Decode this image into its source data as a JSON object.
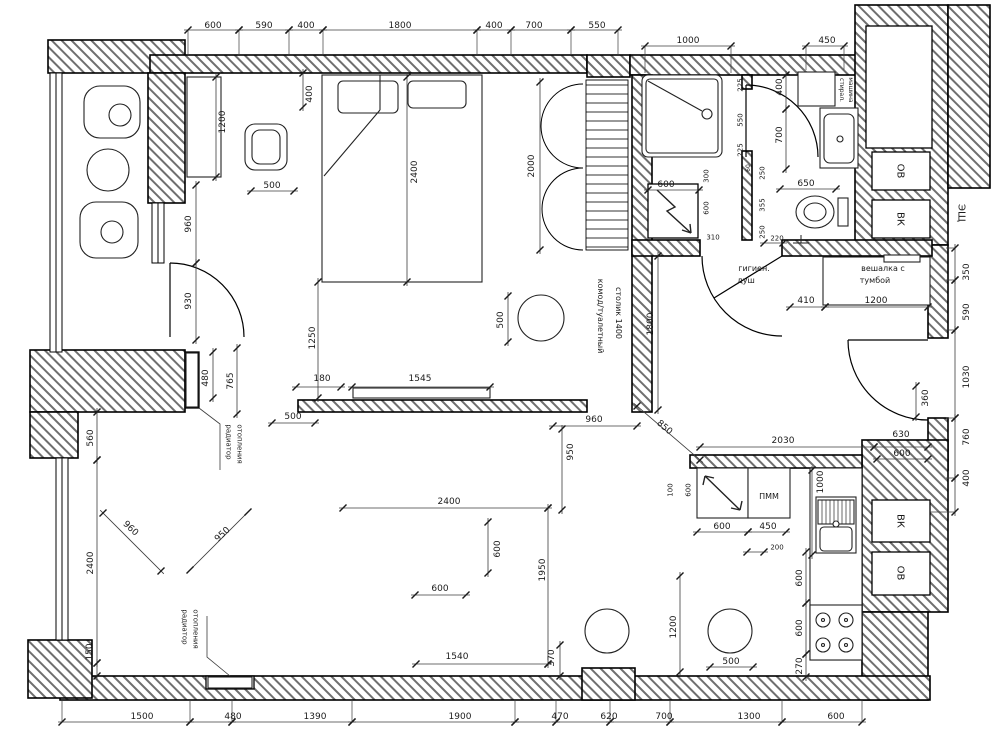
{
  "drawing": {
    "kind": "apartment floor plan",
    "palette": {
      "background": "#ffffff",
      "wall_line": "#000000",
      "hatch": "#6f6f6f",
      "dim_line": "#3c3c3c",
      "text": "#1b1b1b"
    }
  },
  "labels": [
    {
      "t": "600",
      "x": 213,
      "y": 25,
      "l": [
        188,
        30,
        239,
        30
      ]
    },
    {
      "t": "590",
      "x": 264,
      "y": 25,
      "l": [
        239,
        30,
        289,
        30
      ]
    },
    {
      "t": "400",
      "x": 306,
      "y": 25,
      "l": [
        289,
        30,
        323,
        30
      ]
    },
    {
      "t": "1800",
      "x": 400,
      "y": 25,
      "l": [
        323,
        30,
        477,
        30
      ]
    },
    {
      "t": "400",
      "x": 494,
      "y": 25,
      "l": [
        477,
        30,
        511,
        30
      ]
    },
    {
      "t": "700",
      "x": 534,
      "y": 25,
      "l": [
        511,
        30,
        571,
        30
      ]
    },
    {
      "t": "550",
      "x": 597,
      "y": 25,
      "l": [
        571,
        30,
        618,
        30
      ]
    },
    {
      "t": "1000",
      "x": 688,
      "y": 40,
      "l": [
        645,
        46,
        731,
        46
      ]
    },
    {
      "t": "450",
      "x": 827,
      "y": 40,
      "l": [
        806,
        46,
        844,
        46
      ]
    },
    {
      "t": "1500",
      "x": 142,
      "y": 716,
      "l": [
        62,
        722,
        190,
        722
      ]
    },
    {
      "t": "480",
      "x": 233,
      "y": 716,
      "l": [
        190,
        722,
        232,
        722
      ]
    },
    {
      "t": "1390",
      "x": 315,
      "y": 716,
      "l": [
        232,
        722,
        352,
        722
      ]
    },
    {
      "t": "1900",
      "x": 460,
      "y": 716,
      "l": [
        352,
        722,
        515,
        722
      ]
    },
    {
      "t": "470",
      "x": 560,
      "y": 716,
      "l": [
        515,
        722,
        556,
        722
      ]
    },
    {
      "t": "620",
      "x": 609,
      "y": 716,
      "l": [
        556,
        722,
        610,
        722
      ]
    },
    {
      "t": "700",
      "x": 664,
      "y": 716,
      "l": [
        610,
        722,
        670,
        722
      ]
    },
    {
      "t": "1300",
      "x": 749,
      "y": 716,
      "l": [
        670,
        722,
        782,
        722
      ]
    },
    {
      "t": "600",
      "x": 836,
      "y": 716,
      "l": [
        782,
        722,
        862,
        722
      ]
    },
    {
      "t": "350",
      "x": 966,
      "y": 272,
      "r": -90,
      "l": [
        955,
        248,
        955,
        280
      ]
    },
    {
      "t": "590",
      "x": 966,
      "y": 312,
      "r": -90,
      "l": [
        955,
        280,
        955,
        330
      ]
    },
    {
      "t": "1030",
      "x": 966,
      "y": 377,
      "r": -90,
      "l": [
        955,
        330,
        955,
        418
      ]
    },
    {
      "t": "760",
      "x": 966,
      "y": 437,
      "r": -90,
      "l": [
        955,
        418,
        955,
        478
      ]
    },
    {
      "t": "400",
      "x": 966,
      "y": 478,
      "r": -90,
      "l": [
        955,
        478,
        955,
        512
      ]
    },
    {
      "t": "1200",
      "x": 222,
      "y": 122,
      "r": -90,
      "l": [
        216,
        77,
        216,
        177
      ]
    },
    {
      "t": "400",
      "x": 309,
      "y": 94,
      "r": -90,
      "l": [
        303,
        73,
        303,
        107
      ]
    },
    {
      "t": "500",
      "x": 272,
      "y": 185,
      "l": [
        251,
        191,
        294,
        191
      ]
    },
    {
      "t": "2400",
      "x": 414,
      "y": 172,
      "r": -90,
      "l": [
        407,
        77,
        407,
        282
      ]
    },
    {
      "t": "1250",
      "x": 312,
      "y": 338,
      "r": -90,
      "l": [
        318,
        282,
        318,
        398
      ]
    },
    {
      "t": "2000",
      "x": 531,
      "y": 166,
      "r": -90,
      "l": [
        540,
        82,
        540,
        250
      ]
    },
    {
      "t": "500",
      "x": 500,
      "y": 320,
      "r": -90,
      "l": [
        508,
        296,
        508,
        342
      ]
    },
    {
      "t": "960",
      "x": 188,
      "y": 224,
      "r": -90,
      "l": [
        196,
        185,
        196,
        263
      ]
    },
    {
      "t": "930",
      "x": 188,
      "y": 301,
      "r": -90,
      "l": [
        196,
        263,
        196,
        340
      ]
    },
    {
      "t": "480",
      "x": 205,
      "y": 378,
      "r": -90,
      "l": [
        213,
        352,
        213,
        398
      ]
    },
    {
      "t": "765",
      "x": 230,
      "y": 381,
      "r": -90,
      "l": [
        237,
        348,
        237,
        414
      ]
    },
    {
      "t": "560",
      "x": 90,
      "y": 438,
      "r": -90,
      "l": [
        97,
        412,
        97,
        460
      ]
    },
    {
      "t": "2400",
      "x": 90,
      "y": 563,
      "r": -90,
      "l": [
        97,
        460,
        97,
        663
      ]
    },
    {
      "t": "150",
      "x": 89,
      "y": 652,
      "r": -90,
      "l": [
        97,
        663,
        97,
        676
      ]
    },
    {
      "t": "960",
      "x": 131,
      "y": 528,
      "r": 43,
      "l": [
        103,
        513,
        161,
        571
      ]
    },
    {
      "t": "950",
      "x": 222,
      "y": 534,
      "r": -43,
      "l": [
        190,
        570,
        248,
        512
      ]
    },
    {
      "t": "850",
      "x": 665,
      "y": 427,
      "r": 40,
      "l": [
        637,
        406,
        700,
        460
      ]
    },
    {
      "t": "2400",
      "x": 449,
      "y": 501,
      "l": [
        343,
        508,
        548,
        508
      ]
    },
    {
      "t": "600",
      "x": 497,
      "y": 549,
      "r": -90,
      "l": [
        488,
        522,
        488,
        573
      ]
    },
    {
      "t": "600",
      "x": 440,
      "y": 588,
      "l": [
        415,
        595,
        466,
        595
      ]
    },
    {
      "t": "1950",
      "x": 542,
      "y": 570,
      "r": -90,
      "l": [
        548,
        508,
        548,
        664
      ]
    },
    {
      "t": "1540",
      "x": 457,
      "y": 656,
      "l": [
        416,
        664,
        548,
        664
      ]
    },
    {
      "t": "370",
      "x": 551,
      "y": 658,
      "r": -90,
      "l": [
        560,
        645,
        560,
        676
      ]
    },
    {
      "t": "180",
      "x": 322,
      "y": 378,
      "l": [
        296,
        387,
        341,
        387
      ]
    },
    {
      "t": "1545",
      "x": 420,
      "y": 378,
      "l": [
        352,
        387,
        490,
        387
      ]
    },
    {
      "t": "500",
      "x": 293,
      "y": 416,
      "l": [
        272,
        423,
        315,
        423
      ]
    },
    {
      "t": "960",
      "x": 594,
      "y": 419,
      "l": [
        553,
        426,
        637,
        426
      ]
    },
    {
      "t": "950",
      "x": 570,
      "y": 452,
      "r": -90,
      "l": [
        562,
        429,
        562,
        510
      ]
    },
    {
      "t": "1800",
      "x": 650,
      "y": 324,
      "r": -90,
      "l": [
        658,
        256,
        658,
        410
      ]
    },
    {
      "t": "410",
      "x": 806,
      "y": 300,
      "l": [
        790,
        307,
        825,
        307
      ]
    },
    {
      "t": "1200",
      "x": 876,
      "y": 300,
      "l": [
        825,
        307,
        928,
        307
      ]
    },
    {
      "t": "360",
      "x": 925,
      "y": 398,
      "r": -90,
      "l": [
        916,
        386,
        916,
        417
      ]
    },
    {
      "t": "600",
      "x": 666,
      "y": 184,
      "l": [
        648,
        190,
        699,
        190
      ]
    },
    {
      "t": "300",
      "x": 706,
      "y": 176,
      "r": -90,
      "fs": 7
    },
    {
      "t": "600",
      "x": 706,
      "y": 208,
      "r": -90,
      "fs": 7
    },
    {
      "t": "310",
      "x": 713,
      "y": 237,
      "fs": 7
    },
    {
      "t": "225",
      "x": 740,
      "y": 85,
      "r": -90,
      "fs": 7
    },
    {
      "t": "550",
      "x": 740,
      "y": 120,
      "r": -90,
      "fs": 7
    },
    {
      "t": "225",
      "x": 740,
      "y": 150,
      "r": -90,
      "fs": 7
    },
    {
      "t": "60",
      "x": 748,
      "y": 168,
      "r": -90,
      "fs": 6
    },
    {
      "t": "400",
      "x": 779,
      "y": 87,
      "r": -90,
      "l": [
        786,
        75,
        786,
        109
      ]
    },
    {
      "t": "700",
      "x": 779,
      "y": 135,
      "r": -90,
      "l": [
        786,
        109,
        786,
        169
      ]
    },
    {
      "t": "250",
      "x": 762,
      "y": 173,
      "r": -90,
      "fs": 7
    },
    {
      "t": "355",
      "x": 762,
      "y": 205,
      "r": -90,
      "fs": 7
    },
    {
      "t": "250",
      "x": 762,
      "y": 232,
      "r": -90,
      "fs": 7
    },
    {
      "t": "650",
      "x": 806,
      "y": 183,
      "l": [
        780,
        189,
        836,
        189
      ]
    },
    {
      "t": "220",
      "x": 777,
      "y": 238,
      "fs": 7,
      "l": [
        764,
        243,
        783,
        243
      ]
    },
    {
      "t": "2030",
      "x": 783,
      "y": 440,
      "l": [
        700,
        447,
        874,
        447
      ]
    },
    {
      "t": "630",
      "x": 901,
      "y": 434,
      "l": [
        874,
        447,
        928,
        447
      ]
    },
    {
      "t": "600",
      "x": 902,
      "y": 453,
      "l": [
        877,
        459,
        928,
        459
      ]
    },
    {
      "t": "100",
      "x": 670,
      "y": 490,
      "r": -90,
      "fs": 7
    },
    {
      "t": "600",
      "x": 688,
      "y": 490,
      "r": -90,
      "fs": 7
    },
    {
      "t": "600",
      "x": 722,
      "y": 526,
      "l": [
        697,
        532,
        748,
        532
      ]
    },
    {
      "t": "450",
      "x": 768,
      "y": 526,
      "l": [
        748,
        532,
        786,
        532
      ]
    },
    {
      "t": "200",
      "x": 777,
      "y": 547,
      "fs": 7,
      "l": [
        747,
        552,
        764,
        552
      ]
    },
    {
      "t": "1000",
      "x": 820,
      "y": 482,
      "r": -90,
      "l": [
        812,
        470,
        812,
        555
      ]
    },
    {
      "t": "600",
      "x": 799,
      "y": 578,
      "r": -90,
      "l": [
        806,
        552,
        806,
        603
      ]
    },
    {
      "t": "600",
      "x": 799,
      "y": 628,
      "r": -90,
      "l": [
        806,
        603,
        806,
        654
      ]
    },
    {
      "t": "270",
      "x": 799,
      "y": 666,
      "r": -90,
      "l": [
        806,
        654,
        806,
        677
      ]
    },
    {
      "t": "ПММ",
      "x": 769,
      "y": 496,
      "fs": 8
    },
    {
      "t": "1200",
      "x": 673,
      "y": 627,
      "r": -90,
      "l": [
        680,
        576,
        680,
        672
      ]
    },
    {
      "t": "500",
      "x": 731,
      "y": 661,
      "l": [
        710,
        667,
        753,
        667
      ]
    },
    {
      "t": "гигиен.",
      "x": 754,
      "y": 268,
      "fs": 8
    },
    {
      "t": "душ",
      "x": 746,
      "y": 280,
      "fs": 8
    },
    {
      "t": "вешалка с",
      "x": 883,
      "y": 268,
      "fs": 8
    },
    {
      "t": "тумбой",
      "x": 875,
      "y": 280,
      "fs": 8
    },
    {
      "t": "комод/туалетный",
      "x": 601,
      "y": 316,
      "r": 90,
      "fs": 8
    },
    {
      "t": "столик  1400",
      "x": 619,
      "y": 313,
      "r": 90,
      "fs": 8
    },
    {
      "t": "радиатор",
      "x": 229,
      "y": 442,
      "r": 90,
      "fs": 7
    },
    {
      "t": "отопления",
      "x": 240,
      "y": 444,
      "r": 90,
      "fs": 7
    },
    {
      "t": "радиатор",
      "x": 185,
      "y": 627,
      "r": 90,
      "fs": 7
    },
    {
      "t": "отопления",
      "x": 196,
      "y": 629,
      "r": 90,
      "fs": 7
    },
    {
      "t": "стирал.",
      "x": 842,
      "y": 90,
      "r": 90,
      "fs": 6
    },
    {
      "t": "машина",
      "x": 851,
      "y": 90,
      "r": 90,
      "fs": 6
    },
    {
      "t": "ОВ",
      "x": 901,
      "y": 171,
      "r": 90,
      "fs": 10
    },
    {
      "t": "ВК",
      "x": 901,
      "y": 219,
      "r": 90,
      "fs": 10
    },
    {
      "t": "ЭЩ",
      "x": 962,
      "y": 213,
      "r": 90,
      "fs": 10
    },
    {
      "t": "ВК",
      "x": 901,
      "y": 521,
      "r": 90,
      "fs": 10
    },
    {
      "t": "ОВ",
      "x": 901,
      "y": 573,
      "r": 90,
      "fs": 10
    }
  ]
}
